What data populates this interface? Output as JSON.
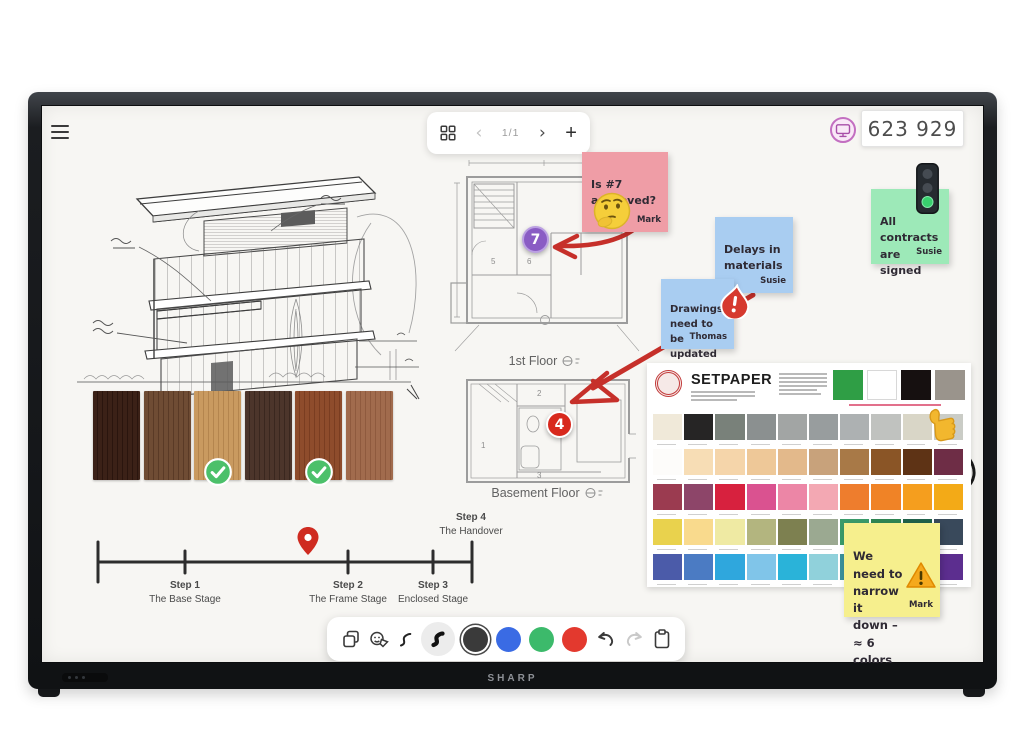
{
  "device": {
    "brand": "SHARP"
  },
  "whiteboard": {
    "top_toolbar": {
      "page_indicator": "1/1",
      "chevron_left": "‹",
      "chevron_right": "›",
      "plus": "+"
    },
    "session": {
      "code": "623 929"
    }
  },
  "sticky_notes": [
    {
      "id": "pink",
      "text": "Is #7\napproved?",
      "author": "Mark",
      "bg": "#ef9da6"
    },
    {
      "id": "blue-delays",
      "text": "Delays in\nmaterials",
      "author": "Susie",
      "bg": "#a9cdf1"
    },
    {
      "id": "blue-drawings",
      "text": "Drawings\nneed to be\nupdated",
      "author": "Thomas",
      "bg": "#a9cdf1"
    },
    {
      "id": "green",
      "text": "All\ncontracts\nare signed",
      "author": "Susie",
      "bg": "#9de9b8"
    },
    {
      "id": "yellow",
      "text": "We need to\nnarrow it\ndown –\n≈ 6 colors",
      "author": "Mark",
      "bg": "#f6ef8d"
    }
  ],
  "floor_plans": [
    {
      "label": "1st Floor",
      "marker": "7",
      "marker_color": "#8a5cc4",
      "rooms": [
        "5",
        "6"
      ]
    },
    {
      "label": "Basement Floor",
      "marker": "4",
      "marker_color": "#d8291d",
      "rooms": [
        "1",
        "2",
        "3"
      ]
    }
  ],
  "timeline": {
    "steps": [
      {
        "step": "Step 1",
        "name": "The Base Stage"
      },
      {
        "step": "Step 2",
        "name": "The Frame Stage"
      },
      {
        "step": "Step 3",
        "name": "Enclosed Stage"
      },
      {
        "step": "Step 4",
        "name": "The Handover"
      }
    ],
    "pin_color": "#cf2b20"
  },
  "annotations": {
    "ink_color": "#c6302a",
    "circle_color": "#1a1a1a"
  },
  "palette_card": {
    "brand": "SETPAPER",
    "header_swatches": [
      "#2f9e45",
      "#ffffff",
      "#161010",
      "#9a948c"
    ],
    "swatch_rows": [
      [
        "#f0e9d9",
        "#262525",
        "#79817a",
        "#8b9090",
        "#a2a5a4",
        "#989d9e",
        "#adb1b2",
        "#c0c2bf",
        "#d9d6c7",
        "#caccc6"
      ],
      [
        "#fdfcfa",
        "#f7ddb5",
        "#f5d5aa",
        "#eec898",
        "#e3b98b",
        "#c8a27b",
        "#a87947",
        "#8a5526",
        "#5e3315",
        "#6e2d46"
      ],
      [
        "#9b3b50",
        "#8d4569",
        "#d7213e",
        "#da5290",
        "#ec86a6",
        "#f3a8b3",
        "#ee7d2d",
        "#f08326",
        "#f59e1e",
        "#f3aa17"
      ],
      [
        "#e9d24d",
        "#f9da8d",
        "#efeaa3",
        "#b3b57f",
        "#7d8050",
        "#9ba991",
        "#3a9a6a",
        "#2f8553",
        "#20614a",
        "#39495b"
      ],
      [
        "#4b5ba9",
        "#4b7bc3",
        "#2fa7dd",
        "#80c5e9",
        "#2ab3d9",
        "#90d1db",
        "#3b909b",
        "#2e80af",
        "#4ba9c1",
        "#5c2e8f"
      ]
    ]
  },
  "materials": {
    "samples": [
      {
        "base": "#3b2117",
        "grain": "#2a150e",
        "approved": false
      },
      {
        "base": "#6f4c34",
        "grain": "#5a3a26",
        "approved": false
      },
      {
        "base": "#c99a60",
        "grain": "#b4854e",
        "approved": true
      },
      {
        "base": "#4c352b",
        "grain": "#3a271f",
        "approved": false
      },
      {
        "base": "#8e4c2c",
        "grain": "#7a3d21",
        "approved": true
      },
      {
        "base": "#a16b4d",
        "grain": "#8f5a3e",
        "approved": false
      }
    ]
  },
  "bottom_toolbar": {
    "pen_colors": [
      {
        "color": "#3a3a3a",
        "selected": true
      },
      {
        "color": "#3a6be4",
        "selected": false
      },
      {
        "color": "#3cba6b",
        "selected": false
      },
      {
        "color": "#e3392e",
        "selected": false
      }
    ]
  }
}
